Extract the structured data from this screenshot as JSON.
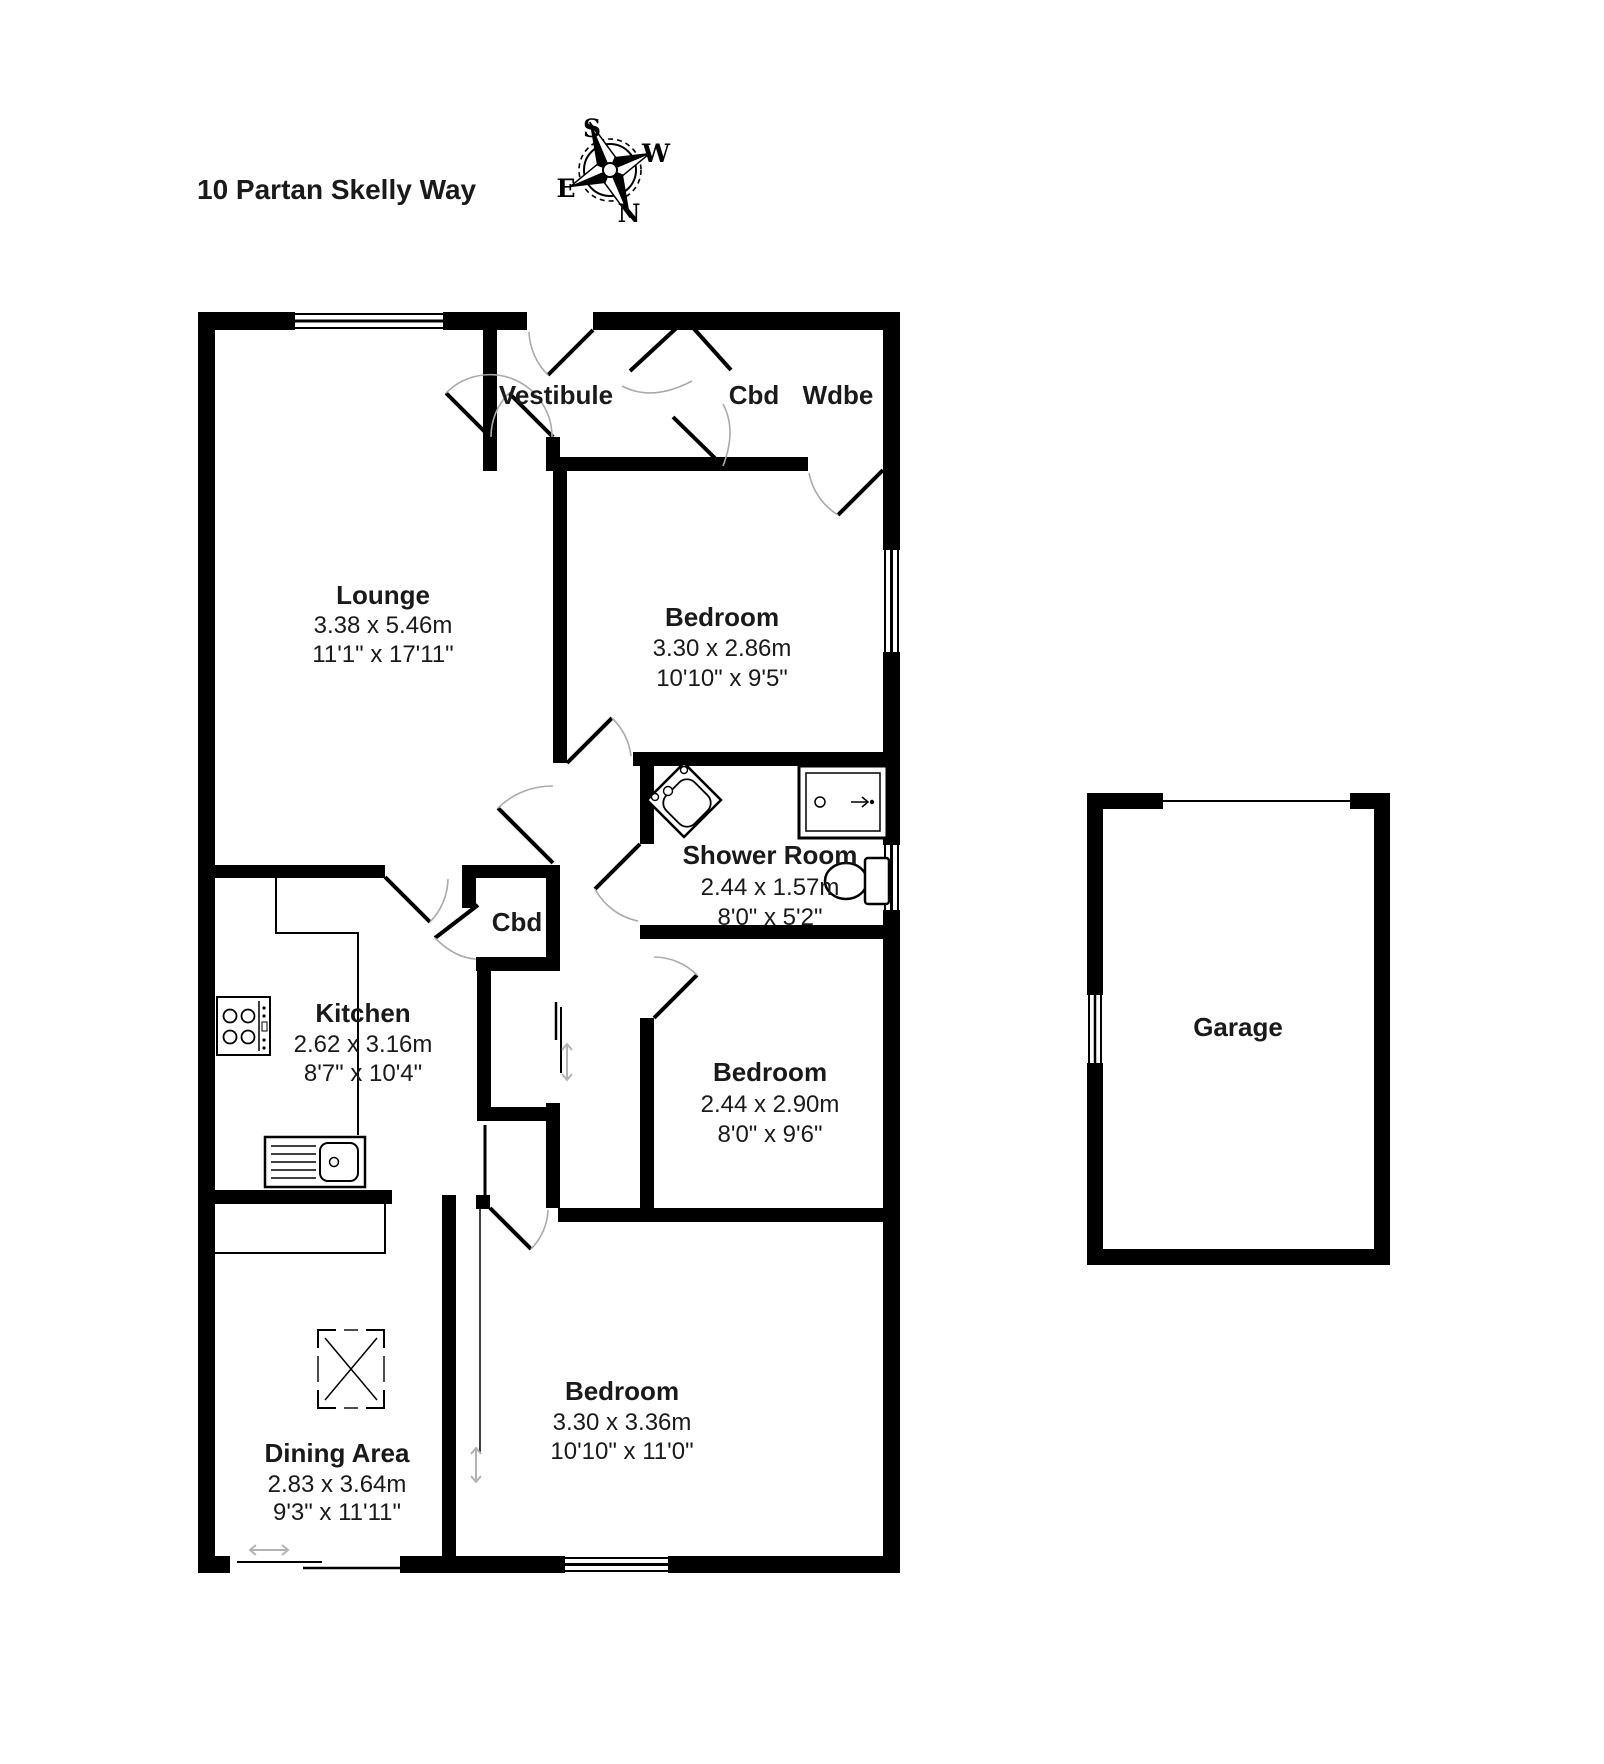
{
  "title": "10 Partan Skelly Way",
  "compass": {
    "n": "N",
    "s": "S",
    "e": "E",
    "w": "W"
  },
  "rooms": {
    "vestibule": {
      "name": "Vestibule"
    },
    "cbd1": {
      "name": "Cbd"
    },
    "wdbe": {
      "name": "Wdbe"
    },
    "lounge": {
      "name": "Lounge",
      "metric": "3.38 x 5.46m",
      "imperial": "11'1\" x 17'11\""
    },
    "bedroom1": {
      "name": "Bedroom",
      "metric": "3.30 x 2.86m",
      "imperial": "10'10\" x 9'5\""
    },
    "shower": {
      "name": "Shower Room",
      "metric": "2.44 x 1.57m",
      "imperial": "8'0\" x 5'2\""
    },
    "cbd2": {
      "name": "Cbd"
    },
    "kitchen": {
      "name": "Kitchen",
      "metric": "2.62 x 3.16m",
      "imperial": "8'7\" x 10'4\""
    },
    "bedroom2": {
      "name": "Bedroom",
      "metric": "2.44 x 2.90m",
      "imperial": "8'0\" x 9'6\""
    },
    "dining": {
      "name": "Dining Area",
      "metric": "2.83 x 3.64m",
      "imperial": "9'3\" x 11'11\""
    },
    "bedroom3": {
      "name": "Bedroom",
      "metric": "3.30 x 3.36m",
      "imperial": "10'10\" x 11'0\""
    },
    "garage": {
      "name": "Garage"
    }
  },
  "colors": {
    "walls": "#000000",
    "door_arc": "#aaaaaa",
    "slider_arrow": "#b3b3b3",
    "text": "#1a1a1a",
    "background": "#ffffff"
  }
}
